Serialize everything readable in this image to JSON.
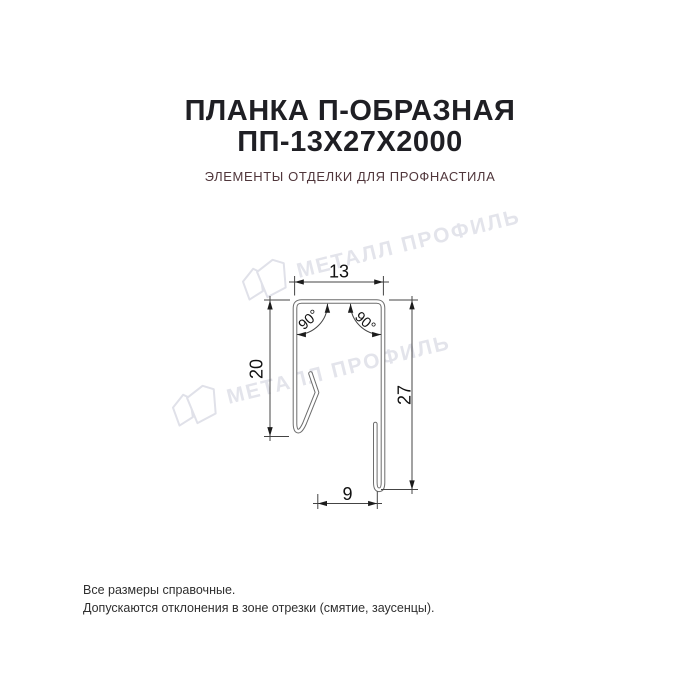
{
  "header": {
    "title_line1": "ПЛАНКА П-ОБРАЗНАЯ",
    "title_line2": "ПП-13Х27Х2000",
    "subtitle": "ЭЛЕМЕНТЫ ОТДЕЛКИ ДЛЯ ПРОФНАСТИЛА"
  },
  "drawing": {
    "dim_top_width": "13",
    "dim_left_height": "20",
    "dim_right_height": "27",
    "dim_bottom_width": "9",
    "angle_top_left": "90°",
    "angle_top_right": "90°"
  },
  "watermark": {
    "text": "МЕТАЛЛ ПРОФИЛЬ"
  },
  "footer": {
    "note1": "Все размеры справочные.",
    "note2": "Допускаются отклонения в зоне отрезки (смятие, заусенцы)."
  },
  "colors": {
    "title_text": "#1f1f24",
    "subtitle_text": "#50363b",
    "profile_line": "#6d6d6d",
    "dimension_line": "#444444",
    "dimension_text": "#111111",
    "watermark": "#e3e4eb",
    "footer_text": "#2f2f2f",
    "background": "#ffffff"
  }
}
